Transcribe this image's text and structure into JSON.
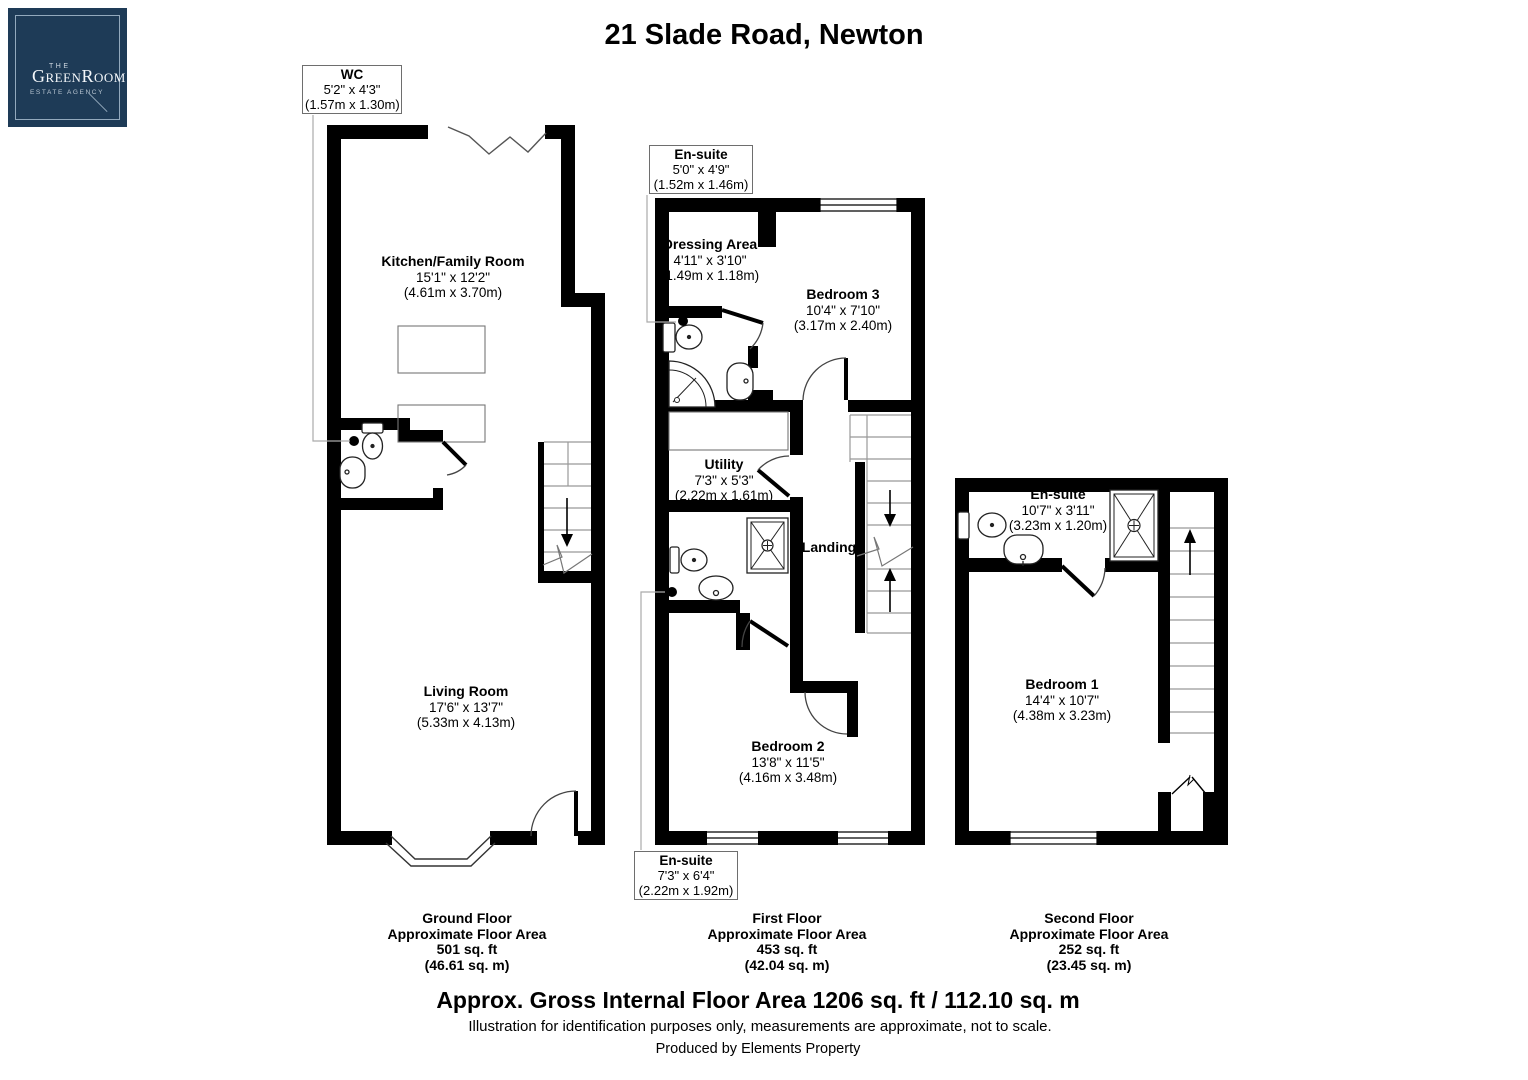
{
  "logo": {
    "the": "THE",
    "name": "GreenRoom",
    "tagline": "ESTATE AGENCY"
  },
  "title": "21 Slade Road, Newton",
  "rooms": {
    "wc": {
      "name": "WC",
      "imperial": "5'2\" x 4'3\"",
      "metric": "(1.57m x 1.30m)"
    },
    "kitchen": {
      "name": "Kitchen/Family Room",
      "imperial": "15'1\" x 12'2\"",
      "metric": "(4.61m x 3.70m)"
    },
    "living": {
      "name": "Living Room",
      "imperial": "17'6\" x 13'7\"",
      "metric": "(5.33m x 4.13m)"
    },
    "ensuite_bed3": {
      "name": "En-suite",
      "imperial": "5'0\" x 4'9\"",
      "metric": "(1.52m x 1.46m)"
    },
    "dressing": {
      "name": "Dressing Area",
      "imperial": "4'11\" x 3'10\"",
      "metric": "(1.49m x 1.18m)"
    },
    "bedroom3": {
      "name": "Bedroom 3",
      "imperial": "10'4\" x 7'10\"",
      "metric": "(3.17m x 2.40m)"
    },
    "utility": {
      "name": "Utility",
      "imperial": "7'3\" x 5'3\"",
      "metric": "(2.22m x 1.61m)"
    },
    "landing": {
      "name": "Landing"
    },
    "bedroom2": {
      "name": "Bedroom 2",
      "imperial": "13'8\" x 11'5\"",
      "metric": "(4.16m x 3.48m)"
    },
    "ensuite_bed2": {
      "name": "En-suite",
      "imperial": "7'3\" x 6'4\"",
      "metric": "(2.22m x 1.92m)"
    },
    "ensuite_bed1": {
      "name": "En-suite",
      "imperial": "10'7\" x 3'11\"",
      "metric": "(3.23m x 1.20m)"
    },
    "bedroom1": {
      "name": "Bedroom 1",
      "imperial": "14'4\" x 10'7\"",
      "metric": "(4.38m x 3.23m)"
    }
  },
  "floors": [
    {
      "id": "ground",
      "lines": [
        "Ground Floor",
        "Approximate Floor Area",
        "501 sq. ft",
        "(46.61 sq. m)"
      ]
    },
    {
      "id": "first",
      "lines": [
        "First Floor",
        "Approximate Floor Area",
        "453 sq. ft",
        "(42.04 sq. m)"
      ]
    },
    {
      "id": "second",
      "lines": [
        "Second Floor",
        "Approximate Floor Area",
        "252 sq. ft",
        "(23.45 sq. m)"
      ]
    }
  ],
  "footer": {
    "gross_area": "Approx. Gross Internal Floor Area 1206 sq. ft / 112.10 sq. m",
    "disclaimer": "Illustration for identification purposes only, measurements are approximate, not to scale.",
    "producer": "Produced by Elements Property"
  },
  "colors": {
    "brand_navy": "#1e3b57",
    "logo_border": "#93a9bd",
    "wall": "#000000"
  }
}
